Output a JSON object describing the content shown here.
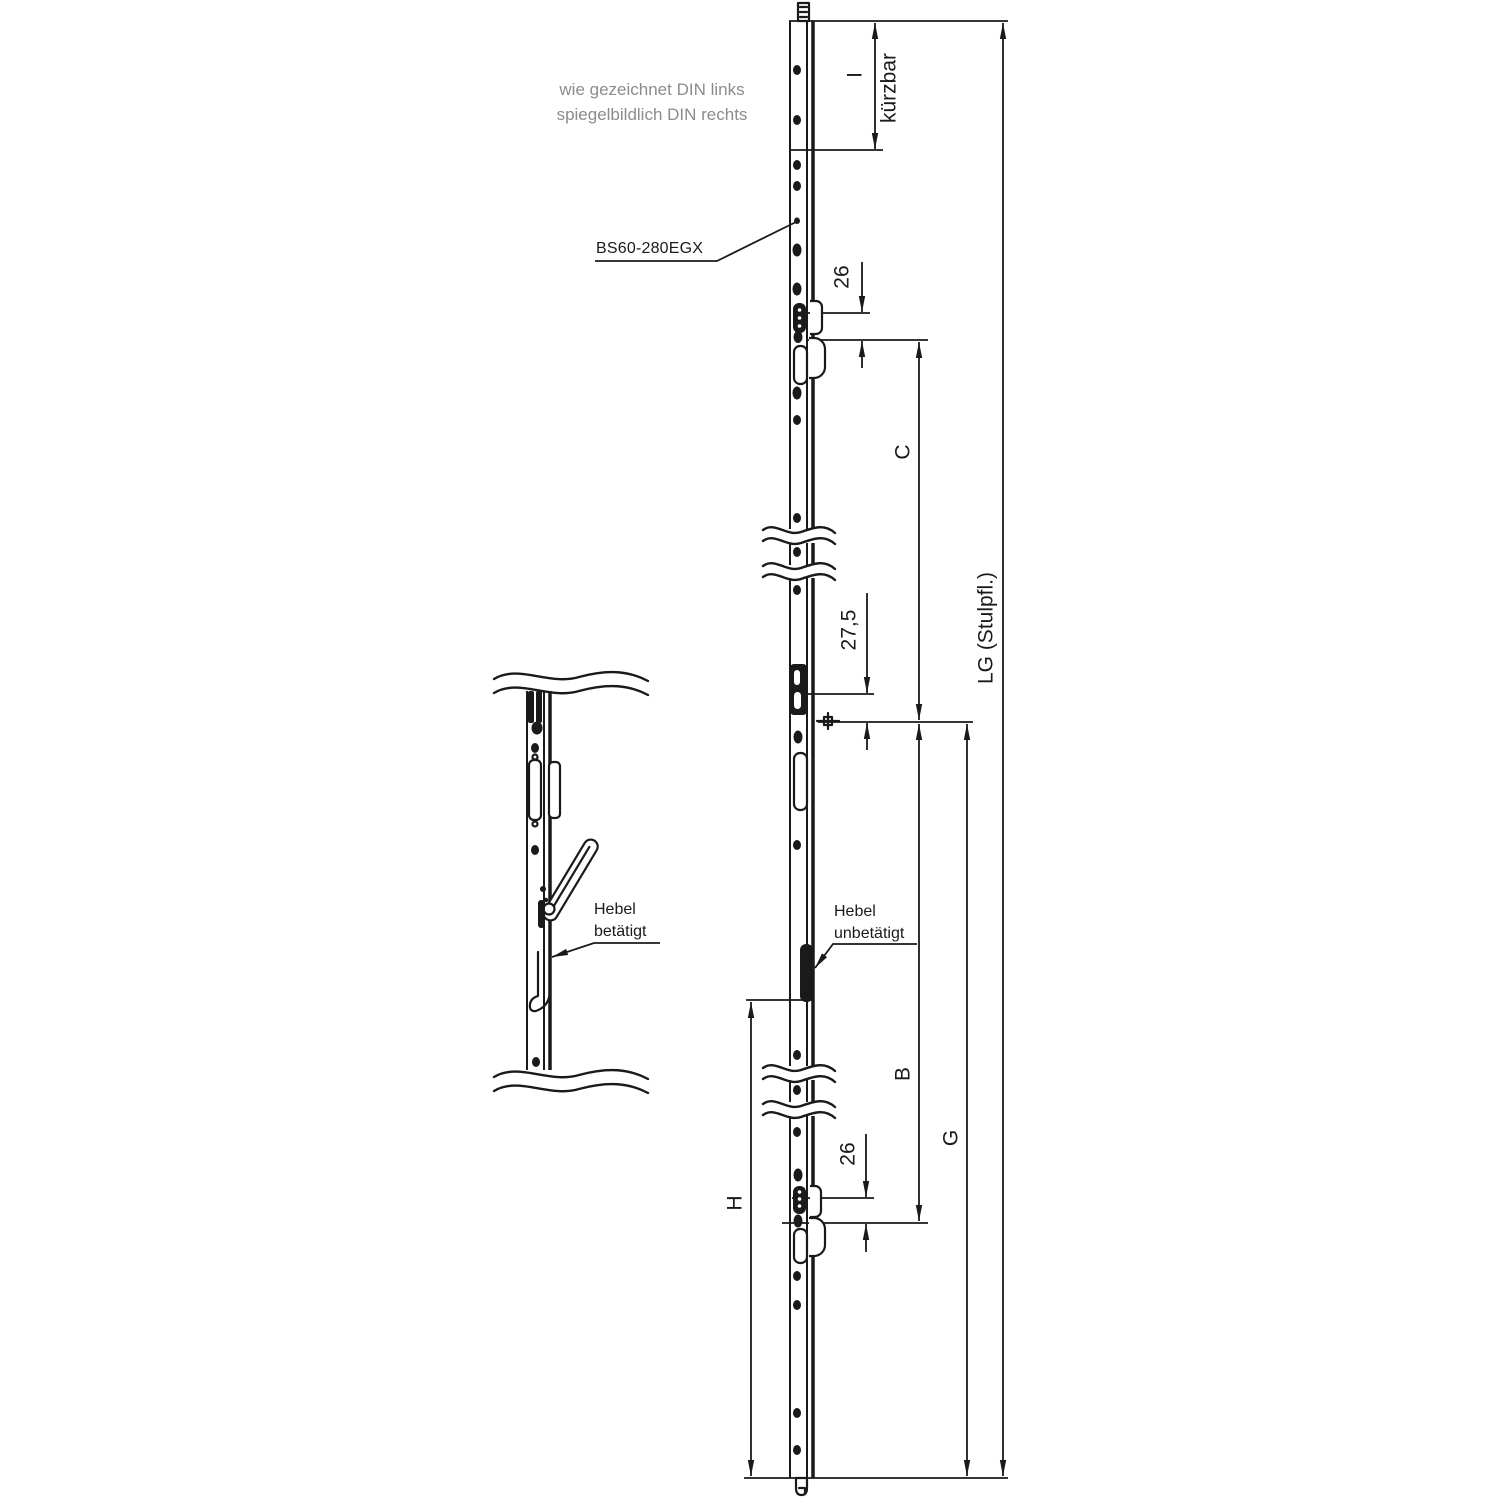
{
  "drawing": {
    "note": {
      "line1": "wie gezeichnet DIN links",
      "line2": "spiegelbildlich DIN rechts"
    },
    "part_label": "BS60-280EGX",
    "dimensions": {
      "I": "I",
      "kuerzbar": "kürzbar",
      "top_26": "26",
      "C": "C",
      "gear_offset": "27,5",
      "LG": "LG (Stulpfl.)",
      "B": "B",
      "G": "G",
      "bottom_26": "26",
      "H": "H"
    },
    "callouts": {
      "lever_actuated": {
        "line1": "Hebel",
        "line2": "betätigt"
      },
      "lever_unactuated": {
        "line1": "Hebel",
        "line2": "unbetätigt"
      }
    },
    "colors": {
      "line": "#1a1a1a",
      "note_text": "#8c8c8c",
      "background": "#ffffff"
    }
  }
}
